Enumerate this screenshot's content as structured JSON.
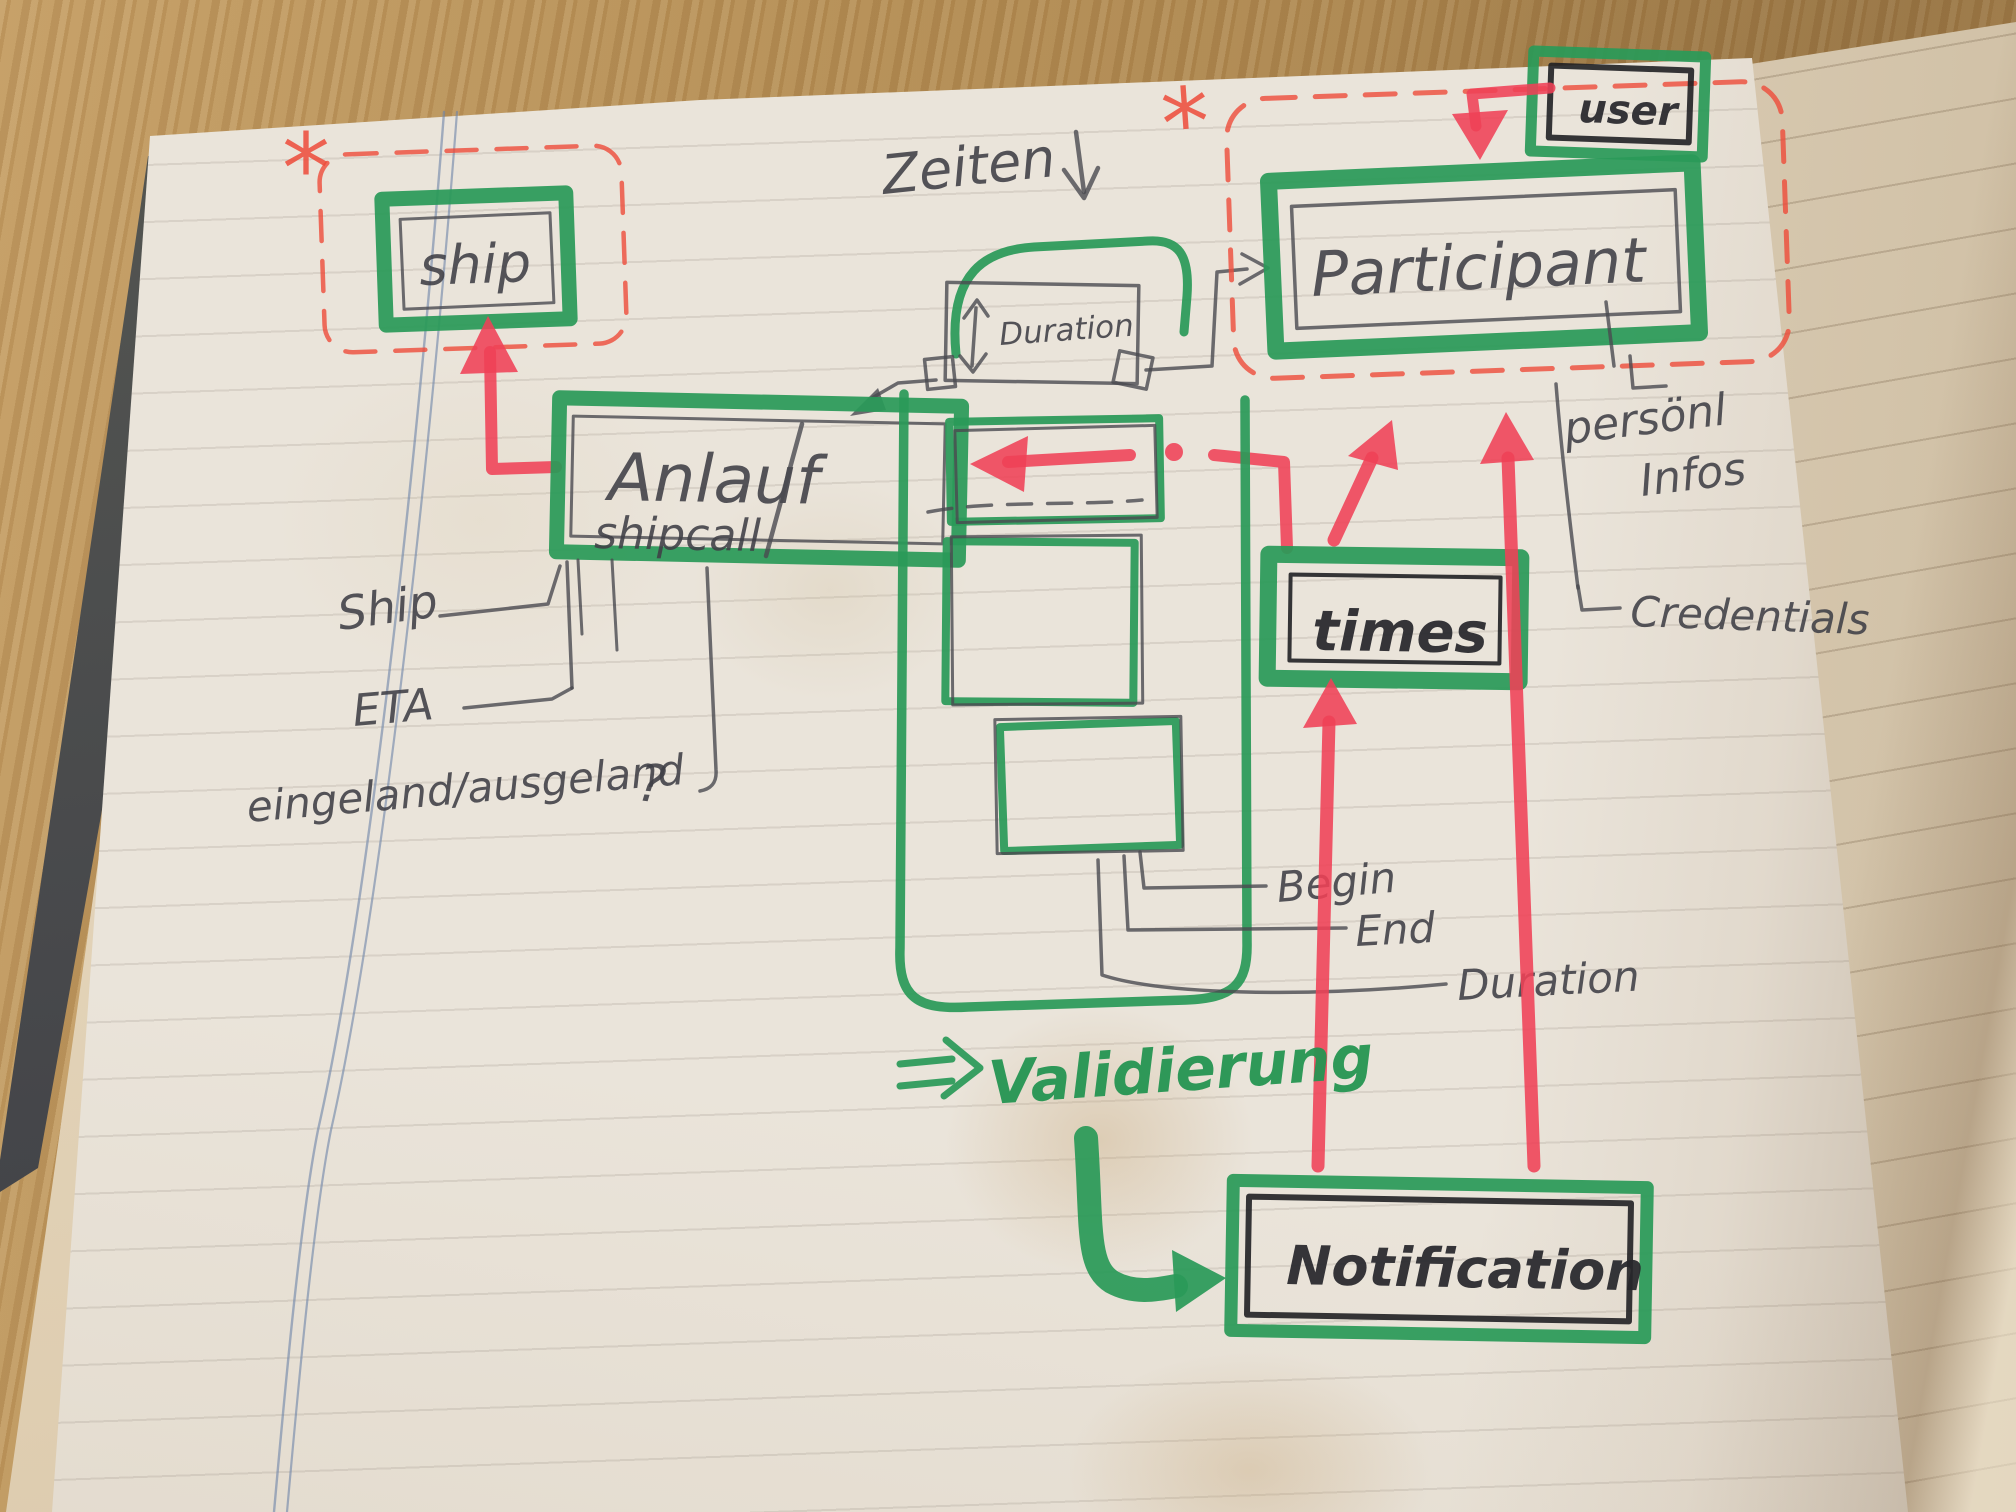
{
  "scene": {
    "description": "Hand-drawn entity sketch in a notebook on a wooden desk"
  },
  "palette": {
    "marker_green": "#2a9a58",
    "marker_red": "#ef4156",
    "dashed_red": "#ee4b3a",
    "pencil": "#4a4a50",
    "ink_black": "#26262b",
    "page": "#eae4da",
    "facing_page": "#ddcfb8",
    "wood": "#b38c52",
    "cover": "#45464a"
  },
  "entities": {
    "ship": {
      "label": "ship"
    },
    "anlauf": {
      "label": "Anlauf",
      "sublabel": "shipcall"
    },
    "participant": {
      "label": "Participant"
    },
    "user": {
      "label": "user"
    },
    "times": {
      "label": "times"
    },
    "notification": {
      "label": "Notification"
    },
    "duration_box": {
      "label": "Duration"
    }
  },
  "annotations": {
    "zeiten": "Zeiten",
    "ship_attr": "Ship",
    "eta_attr": "ETA",
    "inout_attr": "eingeland/ausgeland",
    "inout_question": "?",
    "persoenl_line1": "persönl",
    "persoenl_line2": "Infos",
    "credentials": "Credentials",
    "begin": "Begin",
    "end": "End",
    "duration": "Duration",
    "validierung": "Validierung",
    "asterisk": "*"
  },
  "icons": {
    "zeiten_arrow": "down-arrow",
    "validierung_arrow": "double-right-arrow",
    "notification_arrow": "elbow-right-arrow",
    "flow_arrows": "red-flow-arrow"
  }
}
